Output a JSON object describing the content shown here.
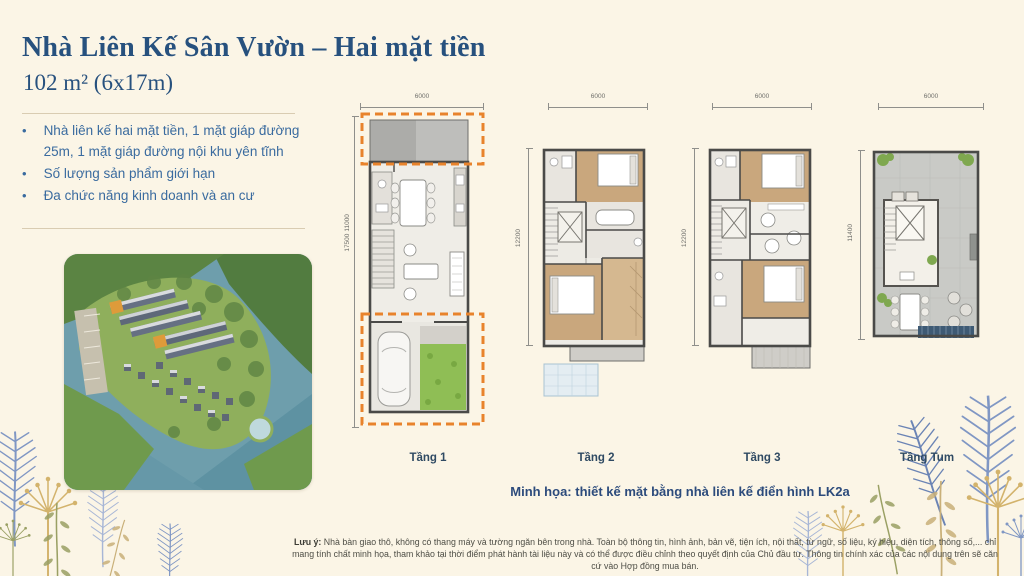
{
  "header": {
    "title": "Nhà Liên Kế Sân Vườn – Hai mặt tiền",
    "subtitle": "102 m² (6x17m)"
  },
  "features": [
    "Nhà liên kế hai mặt tiền, 1 mặt giáp đường 25m, 1 mặt giáp đường nội khu yên tĩnh",
    "Số lượng sản phẩm giới hạn",
    "Đa chức năng kinh doanh và an cư"
  ],
  "plans": [
    {
      "label": "Tầng 1",
      "top_dim": "6000",
      "side_dims": [
        "17500",
        "11000"
      ]
    },
    {
      "label": "Tầng 2",
      "top_dim": "6000",
      "side_dims": [
        "12200"
      ]
    },
    {
      "label": "Tầng 3",
      "top_dim": "6000",
      "side_dims": [
        "12200"
      ]
    },
    {
      "label": "Tầng Tum",
      "top_dim": "6000",
      "side_dims": [
        "11400"
      ]
    }
  ],
  "caption": "Minh họa: thiết kế mặt bằng nhà liên kế điển hình LK2a",
  "disclaimer": {
    "label": "Lưu ý:",
    "text": "Nhà bàn giao thô, không có thang máy và tường ngăn bên trong nhà. Toàn bộ thông tin, hình ảnh, bản vẽ, tiện ích, nội thất, từ ngữ, số liệu, ký hiệu, diện tích, thông số,... chỉ mang tính chất minh họa, tham khảo tại thời điểm phát hành tài liệu này và có thể được điều chỉnh theo quyết định của Chủ đầu tư. Thông tin chính xác của các nội dung trên sẽ căn cứ vào Hợp đồng mua bán."
  },
  "colors": {
    "background": "#FBF5E6",
    "title_blue": "#27517E",
    "body_blue": "#3A6B9F",
    "label_navy": "#2F4A63",
    "dash_orange": "#E8832C",
    "divider_tan": "#D9CCB2",
    "disclaimer_gray": "#4E4E46"
  }
}
